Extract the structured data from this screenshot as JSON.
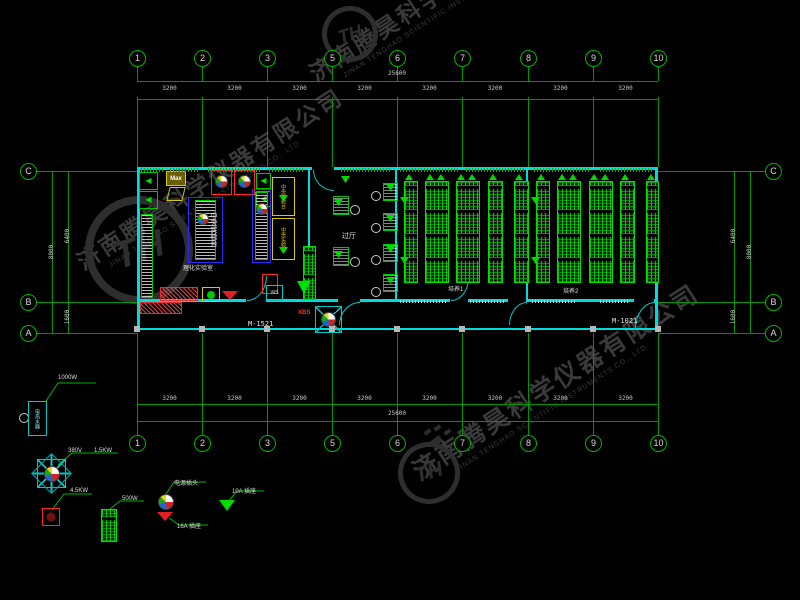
{
  "watermark": {
    "company_cn": "济南腾昊科学仪器有限公司",
    "company_en": "JINAN TENGHAO SCIENTIFIC INSTRUMENTS CO., LTD",
    "logo_text": "TH"
  },
  "grid": {
    "column_bubbles": [
      "1",
      "2",
      "3",
      "5",
      "6",
      "7",
      "8",
      "9",
      "10"
    ],
    "row_bubbles": [
      "C",
      "B",
      "A"
    ],
    "bay_dim": "3200",
    "total_dim": "25600",
    "side_dims": {
      "total": "8000",
      "upper": "6400",
      "lower": "1600"
    }
  },
  "plan": {
    "labels": {
      "left_room": "理化实验室",
      "hall": "过厅",
      "room1": "培养1",
      "room2": "培养2"
    },
    "doors": {
      "left": "M-1521",
      "right": "M-1021"
    },
    "marks": {
      "ws": "WS",
      "xbs": "XBS",
      "max": "Max"
    },
    "bench_text": "中央实验台"
  },
  "legend": {
    "heater_power": "1000W",
    "heater_name": "电热水器",
    "fan_voltage": "380V",
    "fan_power": "1.5KW",
    "unit_power": "4.5KW",
    "rack_power": "500W",
    "plug_label": "电源插头",
    "socket16_label": "16A  插座",
    "socket10_label": "10A  插座"
  },
  "colors": {
    "wall": "#00dcdc",
    "grid": "#009600",
    "rack": "#00e000",
    "hood": "#ff2828",
    "cabinet": "#d8c800"
  }
}
